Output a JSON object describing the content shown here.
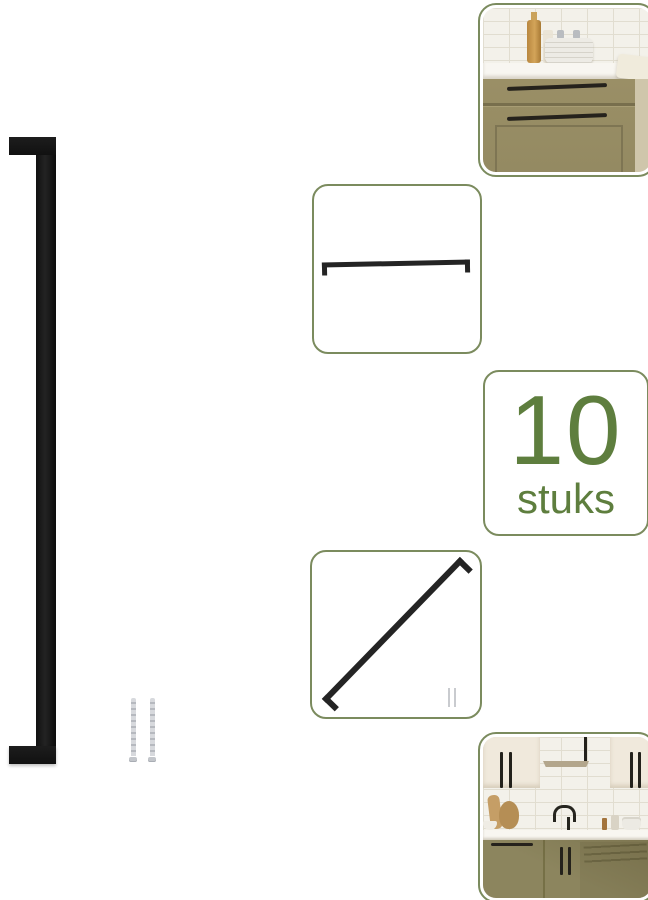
{
  "image": {
    "kind": "product-collage",
    "background": "#ffffff",
    "accent_border_color": "#7b8b5e",
    "accent_text_color": "#5e7e3e",
    "handle_color": "#1a1a1a",
    "screw_color": "#c6c8cc"
  },
  "quantity_badge": {
    "number": "10",
    "unit": "stuks"
  },
  "panels": {
    "kitchen_photo_top": "kitchen drawer unit with two black bar handles",
    "handle_front_view": "bar handle front view line illustration",
    "handle_angled_view": "bar handle angled view illustration with mounting screws",
    "kitchen_photo_bottom": "full kitchen with black bar handles on cabinets"
  },
  "loose_parts": {
    "screws_visible": 2
  }
}
